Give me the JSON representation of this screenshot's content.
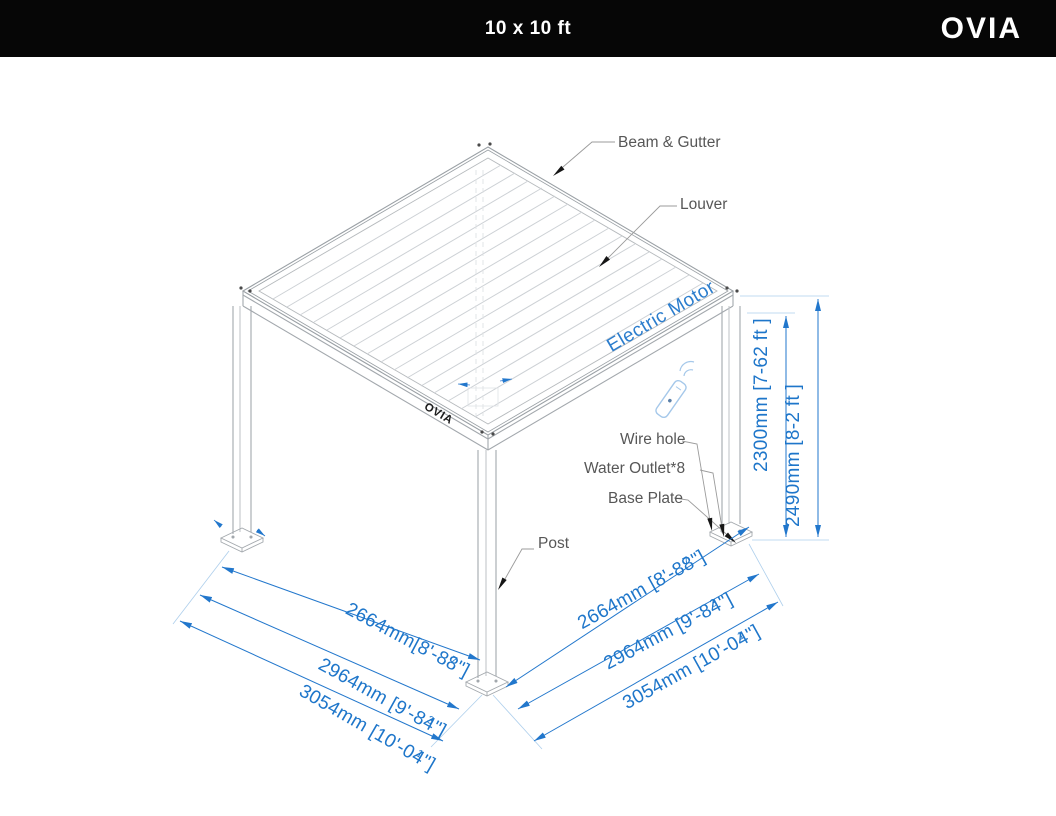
{
  "header": {
    "title": "10 x 10 ft",
    "brand": "OVIA"
  },
  "beam_logo": "OVIA",
  "labels": {
    "beam_gutter": "Beam & Gutter",
    "louver": "Louver",
    "electric_motor": "Electric Motor",
    "wire_hole": "Wire hole",
    "water_outlet": "Water Outlet*8",
    "base_plate": "Base Plate",
    "post": "Post"
  },
  "dims": {
    "width_left": [
      {
        "mm": "2664mm",
        "pre": "[8'-8",
        "num": "7",
        "den": "8",
        "suf": "\"]"
      },
      {
        "mm": "2964mm",
        "pre": " [9'-8",
        "num": "3",
        "den": "4",
        "suf": "\"]"
      },
      {
        "mm": "3054mm",
        "pre": " [10'-0",
        "num": "1",
        "den": "4",
        "suf": "\"]"
      }
    ],
    "width_right": [
      {
        "mm": "2664mm",
        "pre": " [8'-8",
        "num": "7",
        "den": "8",
        "suf": "\"]"
      },
      {
        "mm": "2964mm",
        "pre": " [9'-8",
        "num": "3",
        "den": "4",
        "suf": "\"]"
      },
      {
        "mm": "3054mm",
        "pre": " [10'-0",
        "num": "1",
        "den": "4",
        "suf": "\"]"
      }
    ],
    "heights": [
      {
        "text": "2300mm [7-62 ft ]"
      },
      {
        "text": "2490mm [8-2 ft ]"
      }
    ]
  },
  "colors": {
    "dimension_blue": "#1e76ca",
    "label_gray": "#575757",
    "line_gray": "#a9adb2",
    "header_black": "#060606"
  }
}
